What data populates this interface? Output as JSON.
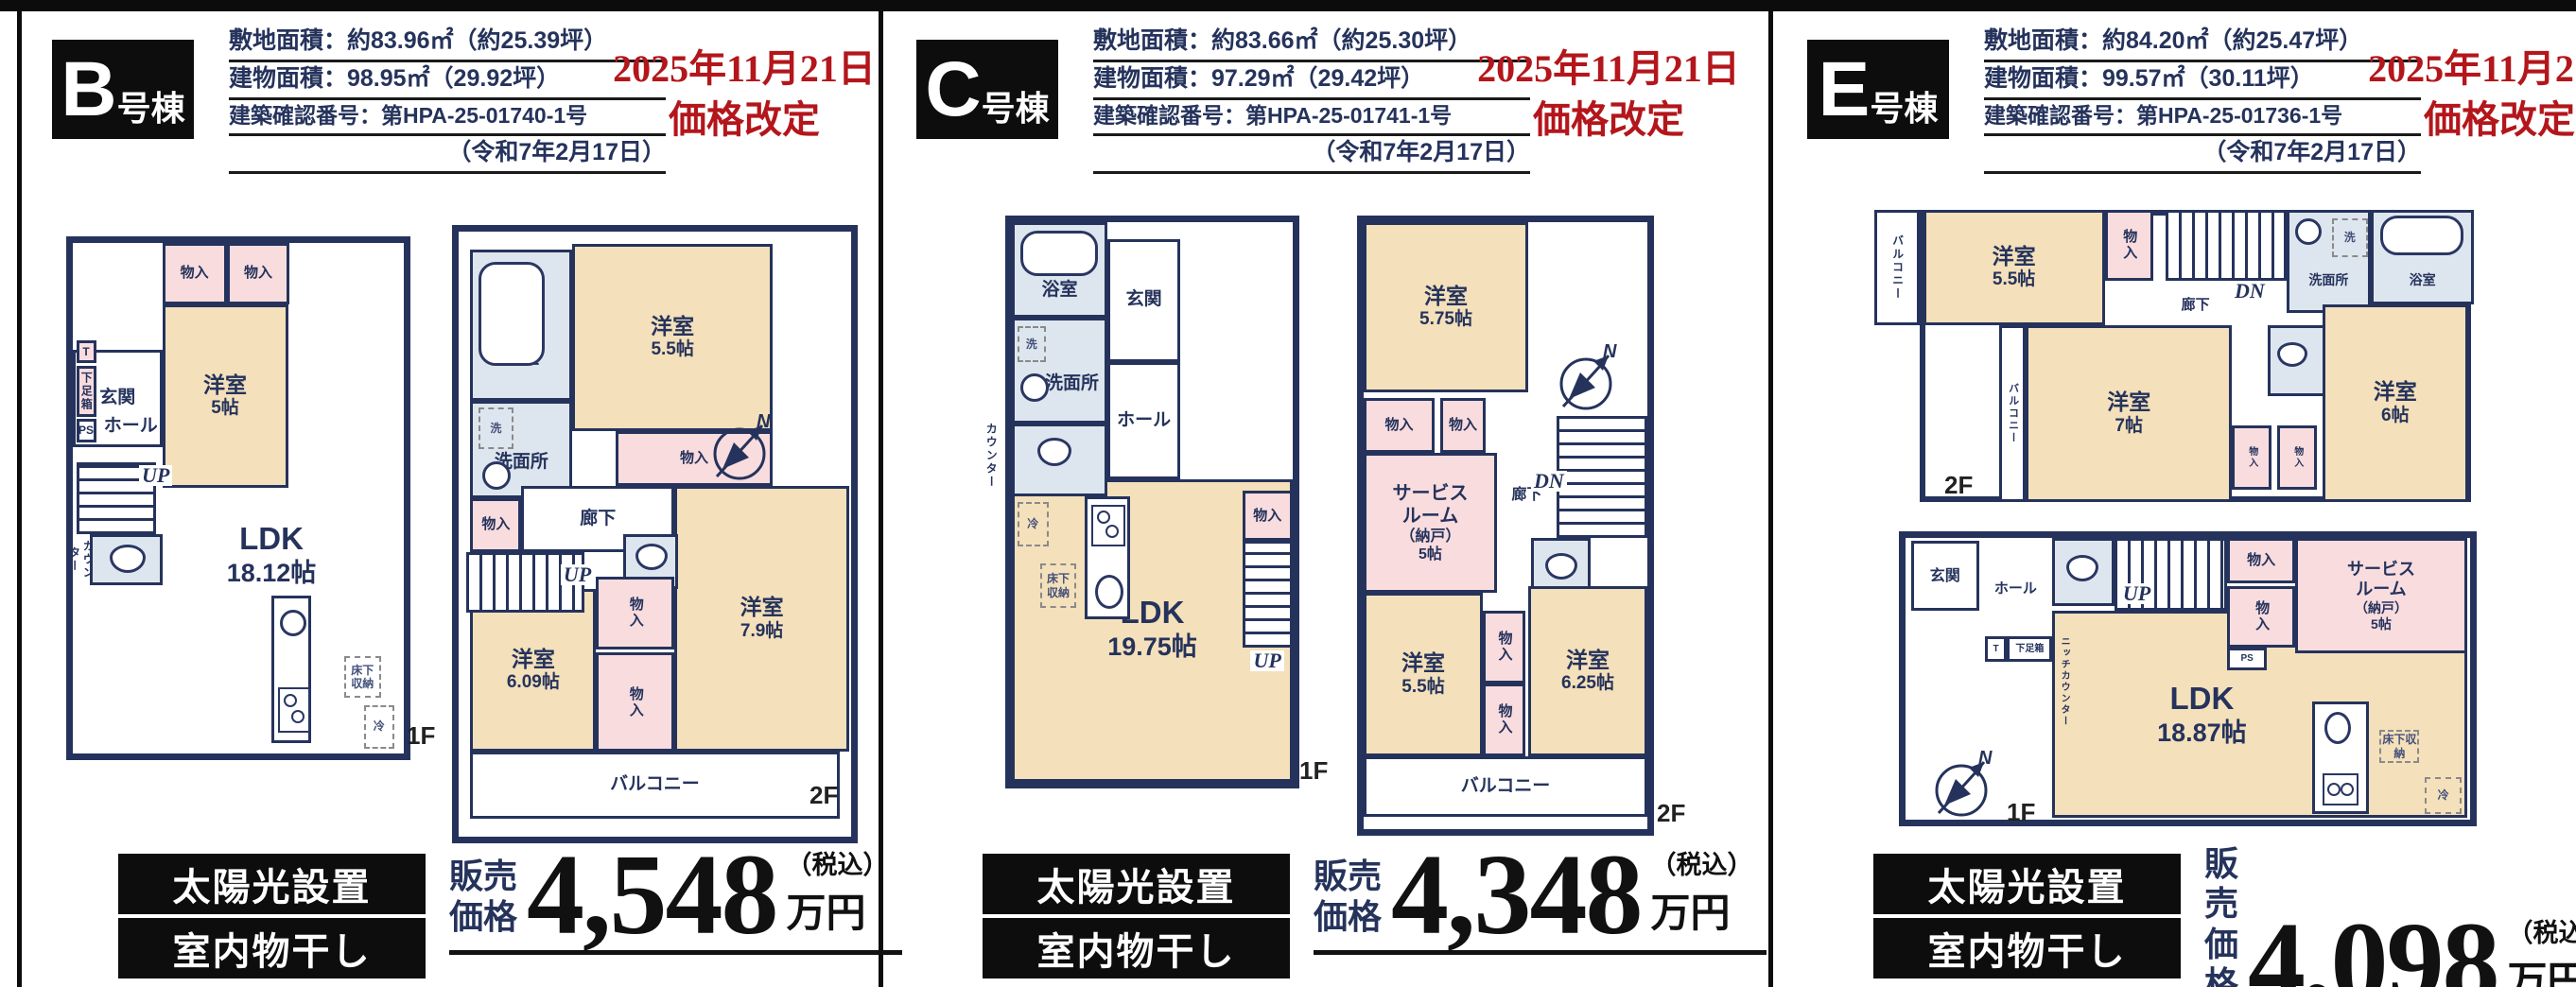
{
  "page": {
    "compass_n": "N",
    "accent_red": "#b3161b",
    "wall_navy": "#25335c",
    "room_beige": "#f4e0ba",
    "closet_pink": "#f9dcde",
    "wet_blue": "#dde6ee"
  },
  "buildings": [
    {
      "letter": "B",
      "suffix": "号棟",
      "info": [
        "敷地面積：約83.96㎡（約25.39坪）",
        "建物面積：98.95㎡（29.92坪）",
        "建築確認番号：第HPA-25-01740-1号",
        "（令和7年2月17日）"
      ],
      "notice": [
        "2025年11月21日",
        "価格改定"
      ],
      "badges": [
        "太陽光設置",
        "室内物干し"
      ],
      "price": {
        "prefix": "販売\n価格",
        "amount": "4,548",
        "tax": "（税込）",
        "unit": "万円"
      },
      "floors": [
        {
          "label": "1F",
          "rooms": [
            {
              "name": "玄関"
            },
            {
              "name": "T"
            },
            {
              "name": "下足箱"
            },
            {
              "name": "PS"
            },
            {
              "name": "ホール"
            },
            {
              "name": "UP"
            },
            {
              "name": "カウンター"
            },
            {
              "name": "物入"
            },
            {
              "name": "物入"
            },
            {
              "name": "洋室",
              "size": "5帖"
            },
            {
              "name": "LDK",
              "size": "18.12帖"
            },
            {
              "name": "床下収納"
            },
            {
              "name": "冷"
            }
          ]
        },
        {
          "label": "2F",
          "rooms": [
            {
              "name": "浴室"
            },
            {
              "name": "洗"
            },
            {
              "name": "洗面所"
            },
            {
              "name": "物入"
            },
            {
              "name": "廊下"
            },
            {
              "name": "UP"
            },
            {
              "name": "洋室",
              "size": "5.5帖"
            },
            {
              "name": "物入"
            },
            {
              "name": "洋室",
              "size": "7.9帖"
            },
            {
              "name": "物入"
            },
            {
              "name": "物入"
            },
            {
              "name": "洋室",
              "size": "6.09帖"
            },
            {
              "name": "バルコニー"
            }
          ]
        }
      ]
    },
    {
      "letter": "C",
      "suffix": "号棟",
      "info": [
        "敷地面積：約83.66㎡（約25.30坪）",
        "建物面積：97.29㎡（29.42坪）",
        "建築確認番号：第HPA-25-01741-1号",
        "（令和7年2月17日）"
      ],
      "notice": [
        "2025年11月21日",
        "価格改定"
      ],
      "badges": [
        "太陽光設置",
        "室内物干し"
      ],
      "price": {
        "prefix": "販売\n価格",
        "amount": "4,348",
        "tax": "（税込）",
        "unit": "万円"
      },
      "floors": [
        {
          "label": "1F",
          "rooms": [
            {
              "name": "浴室"
            },
            {
              "name": "玄関"
            },
            {
              "name": "下足箱"
            },
            {
              "name": "洗"
            },
            {
              "name": "洗面所"
            },
            {
              "name": "ホール"
            },
            {
              "name": "カウンター"
            },
            {
              "name": "冷"
            },
            {
              "name": "床下収納"
            },
            {
              "name": "物入"
            },
            {
              "name": "UP"
            },
            {
              "name": "LDK",
              "size": "19.75帖"
            }
          ]
        },
        {
          "label": "2F",
          "rooms": [
            {
              "name": "洋室",
              "size": "5.75帖"
            },
            {
              "name": "物入"
            },
            {
              "name": "物入"
            },
            {
              "name": "サービス\nルーム",
              "size": "（納戸）\n5帖"
            },
            {
              "name": "廊下"
            },
            {
              "name": "DN"
            },
            {
              "name": "洋室",
              "size": "5.5帖"
            },
            {
              "name": "物入"
            },
            {
              "name": "物入"
            },
            {
              "name": "洋室",
              "size": "6.25帖"
            },
            {
              "name": "バルコニー"
            }
          ]
        }
      ]
    },
    {
      "letter": "E",
      "suffix": "号棟",
      "info": [
        "敷地面積：約84.20㎡（約25.47坪）",
        "建物面積：99.57㎡（30.11坪）",
        "建築確認番号：第HPA-25-01736-1号",
        "（令和7年2月17日）"
      ],
      "notice": [
        "2025年11月21日",
        "価格改定"
      ],
      "badges": [
        "太陽光設置",
        "室内物干し"
      ],
      "price": {
        "prefix": "販売\n価格",
        "amount": "4,098",
        "tax": "（税込）",
        "unit": "万円"
      },
      "floors": [
        {
          "label": "2F",
          "rooms": [
            {
              "name": "バルコニー"
            },
            {
              "name": "洋室",
              "size": "5.5帖"
            },
            {
              "name": "物入"
            },
            {
              "name": "DN"
            },
            {
              "name": "廊下"
            },
            {
              "name": "洗"
            },
            {
              "name": "洗面所"
            },
            {
              "name": "浴室"
            },
            {
              "name": "バルコニー"
            },
            {
              "name": "洋室",
              "size": "7帖"
            },
            {
              "name": "物入"
            },
            {
              "name": "物入"
            },
            {
              "name": "洋室",
              "size": "6帖"
            }
          ]
        },
        {
          "label": "1F",
          "rooms": [
            {
              "name": "玄関"
            },
            {
              "name": "ホール"
            },
            {
              "name": "T"
            },
            {
              "name": "下足箱"
            },
            {
              "name": "UP"
            },
            {
              "name": "物入"
            },
            {
              "name": "物入"
            },
            {
              "name": "PS"
            },
            {
              "name": "ニッチカウンター"
            },
            {
              "name": "LDK",
              "size": "18.87帖"
            },
            {
              "name": "サービス\nルーム",
              "size": "（納戸）\n5帖"
            },
            {
              "name": "床下収納"
            },
            {
              "name": "冷"
            }
          ]
        }
      ]
    }
  ]
}
